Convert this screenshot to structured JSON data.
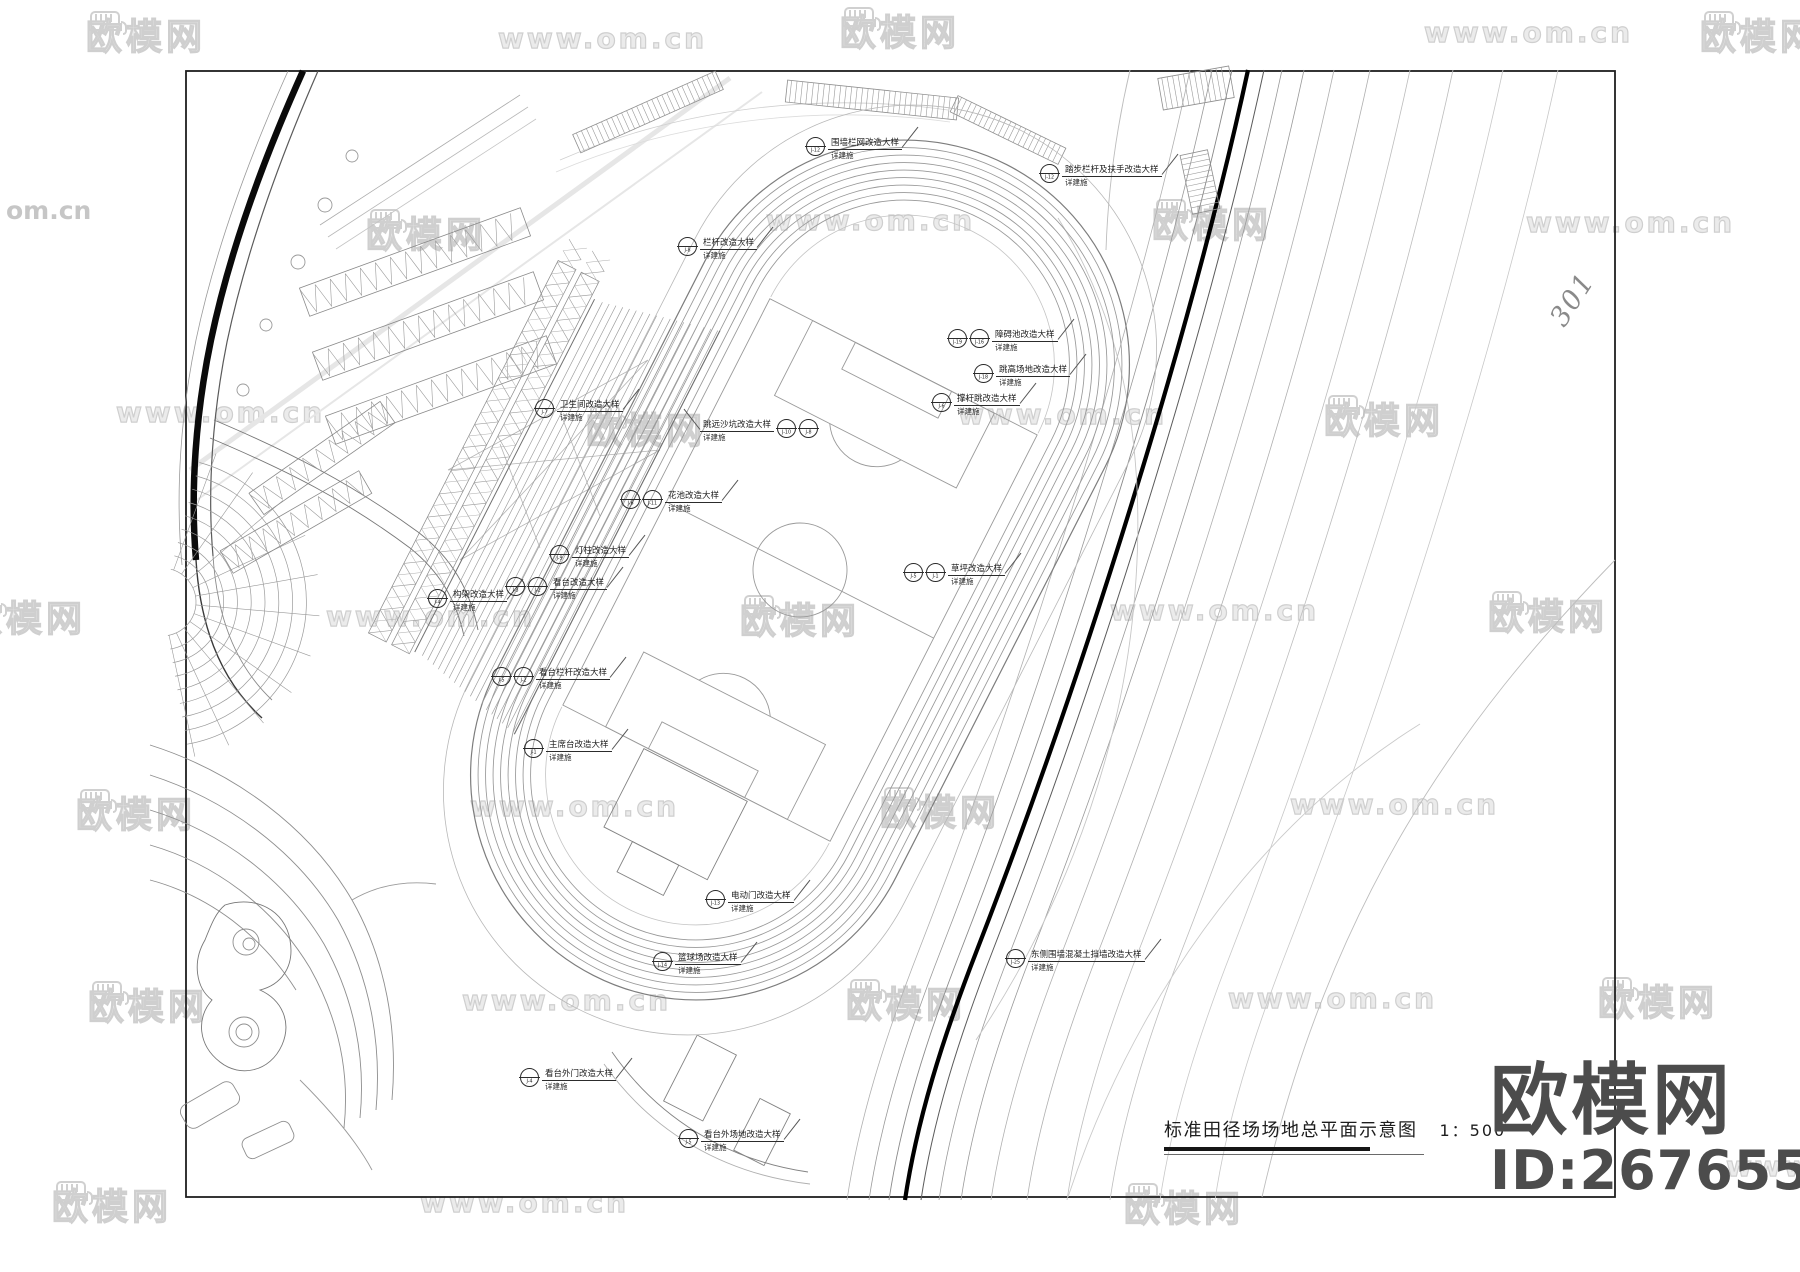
{
  "watermark": {
    "brand": "欧模网",
    "url": "www.om.cn",
    "url_short": "om.cn"
  },
  "branding": {
    "logo_text": "欧模网",
    "id_text": "ID:2676558"
  },
  "title_block": {
    "title": "标准田径场场地总平面示意图",
    "scale_label": "1：500"
  },
  "annotations": {
    "road_number": "301",
    "note_suffix": "详建施"
  },
  "callouts": [
    {
      "x": 806,
      "y": 137,
      "bubbles": [
        "J-12"
      ],
      "label": "围墙栏网改造大样"
    },
    {
      "x": 1040,
      "y": 164,
      "bubbles": [
        "J-12"
      ],
      "label": "踏步栏杆及扶手改造大样"
    },
    {
      "x": 678,
      "y": 237,
      "bubbles": [
        "J-8"
      ],
      "label": "栏杆改造大样"
    },
    {
      "x": 948,
      "y": 329,
      "bubbles": [
        "J-19",
        "J-16"
      ],
      "label": "障碍池改造大样"
    },
    {
      "x": 974,
      "y": 364,
      "bubbles": [
        "J-18"
      ],
      "label": "跳高场地改造大样"
    },
    {
      "x": 932,
      "y": 393,
      "bubbles": [
        "J-6"
      ],
      "label": "撑杆跳改造大样"
    },
    {
      "x": 535,
      "y": 399,
      "bubbles": [
        "J-7"
      ],
      "label": "卫生间改造大样"
    },
    {
      "x": 700,
      "y": 419,
      "bubbles": [
        "J-8",
        "J-10"
      ],
      "label": "跳远沙坑改造大样",
      "side": "left"
    },
    {
      "x": 621,
      "y": 490,
      "bubbles": [
        "J-6",
        "J-11"
      ],
      "label": "花池改造大样"
    },
    {
      "x": 550,
      "y": 545,
      "bubbles": [
        "J-9"
      ],
      "label": "灯柱改造大样"
    },
    {
      "x": 428,
      "y": 589,
      "bubbles": [
        "J-4"
      ],
      "label": "构架改造大样"
    },
    {
      "x": 506,
      "y": 577,
      "bubbles": [
        "J-3",
        "J-2"
      ],
      "label": "看台改造大样"
    },
    {
      "x": 492,
      "y": 667,
      "bubbles": [
        "J-5",
        "J-2"
      ],
      "label": "看台栏杆改造大样"
    },
    {
      "x": 524,
      "y": 739,
      "bubbles": [
        "J-1"
      ],
      "label": "主席台改造大样"
    },
    {
      "x": 904,
      "y": 563,
      "bubbles": [
        "J-5",
        "J-1"
      ],
      "label": "草坪改造大样"
    },
    {
      "x": 706,
      "y": 890,
      "bubbles": [
        "J-13"
      ],
      "label": "电动门改造大样"
    },
    {
      "x": 653,
      "y": 952,
      "bubbles": [
        "J-14"
      ],
      "label": "篮球场改造大样"
    },
    {
      "x": 520,
      "y": 1068,
      "bubbles": [
        "J-4"
      ],
      "label": "看台外门改造大样"
    },
    {
      "x": 679,
      "y": 1129,
      "bubbles": [
        "J-5"
      ],
      "label": "看台外场地改造大样"
    },
    {
      "x": 1006,
      "y": 949,
      "bubbles": [
        "J-25"
      ],
      "label": "东侧围墙混凝土挡墙改造大样"
    }
  ]
}
